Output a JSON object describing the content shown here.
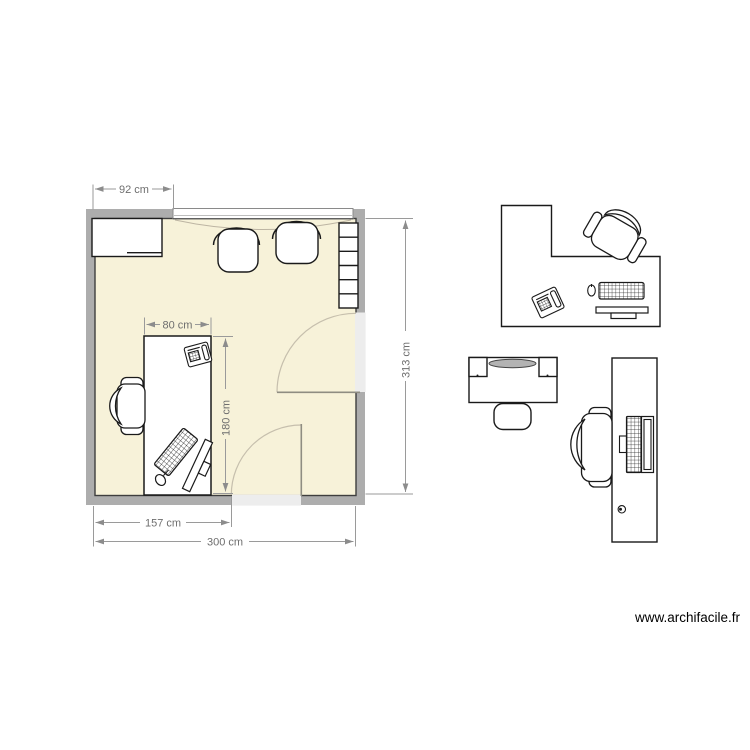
{
  "watermark": {
    "label": "www.archifacile.fr"
  },
  "plan": {
    "dims": {
      "d92": "92 cm",
      "d80": "80 cm",
      "d180": "180 cm",
      "d313": "313 cm",
      "d157": "157 cm",
      "d300": "300 cm"
    },
    "room": {
      "furniture": [
        "wardrobe-cabinet",
        "chair",
        "chair",
        "shelf-unit",
        "desk",
        "office-chair",
        "desk-phone",
        "keyboard",
        "mouse",
        "monitor"
      ],
      "openings": [
        "window-top",
        "door-right",
        "door-bottom"
      ]
    }
  },
  "palette": {
    "items": [
      "corner-desk-workstation",
      "office-chair",
      "desk-phone",
      "mouse",
      "keyboard",
      "monitor",
      "dressing-table",
      "stool",
      "computer-desk",
      "office-chair",
      "computer-screen",
      "mouse"
    ]
  },
  "colors": {
    "floor": "#f7f2d9",
    "wall": "#adadad",
    "wall_edge": "#3e3e3e",
    "furniture_outline": "#1a1a1a",
    "dimension": "#8c8c8c",
    "door_leaf": "#8f8d82",
    "door_arc": "#c6bfad"
  }
}
